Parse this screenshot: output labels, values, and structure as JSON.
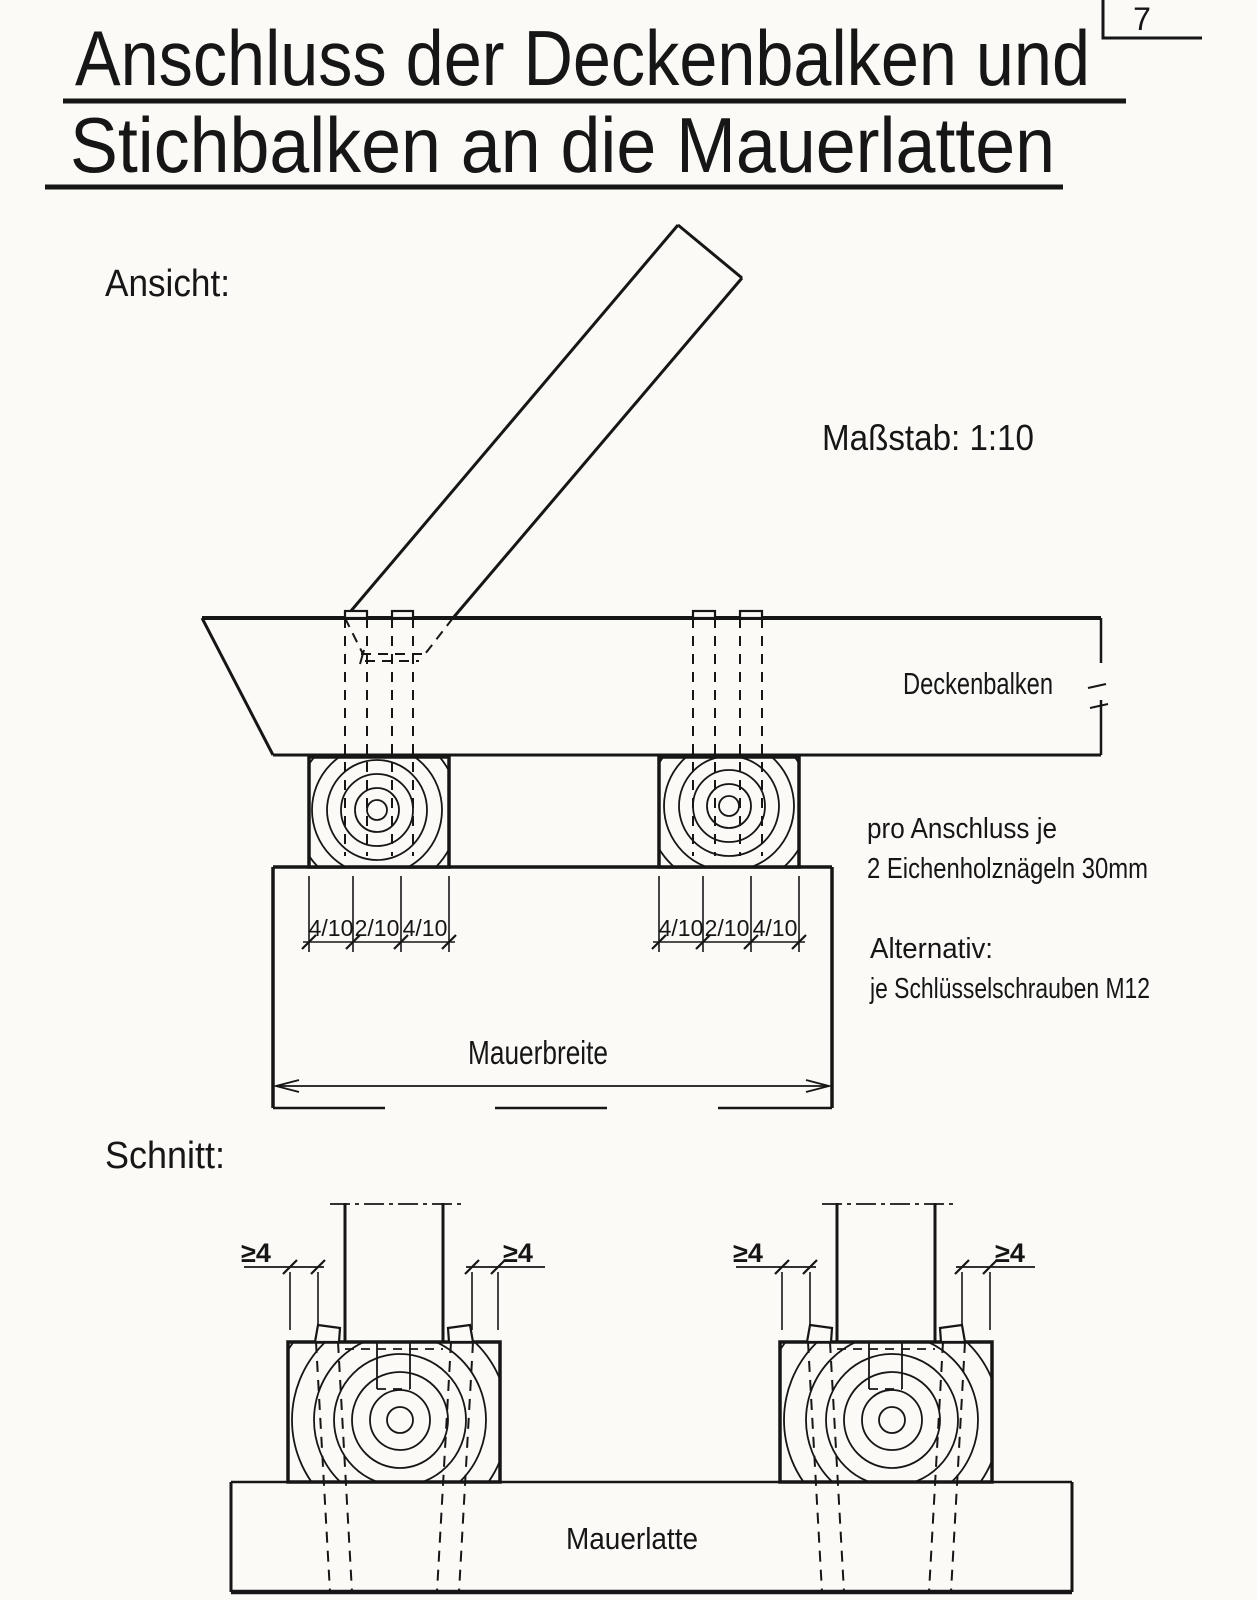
{
  "page": {
    "number": "7",
    "paper_color": "#fbfaf7",
    "ink_color": "#161616"
  },
  "title": {
    "line1": "Anschluss der Deckenbalken und",
    "line2": "Stichbalken an die Mauerlatten"
  },
  "ansicht": {
    "label": "Ansicht:",
    "scale_note": "Maßstab: 1:10",
    "beam_label": "Deckenbalken",
    "wall_width_label": "Mauerbreite",
    "dim_chain": [
      "4/10",
      "2/10",
      "4/10"
    ],
    "note_line1": "pro Anschluss je",
    "note_line2": "2 Eichenholznägeln 30mm",
    "note_line3": "Alternativ:",
    "note_line4": "je Schlüsselschrauben M12"
  },
  "schnitt": {
    "label": "Schnitt:",
    "plate_label": "Mauerlatte",
    "edge_distance": "≥4"
  }
}
